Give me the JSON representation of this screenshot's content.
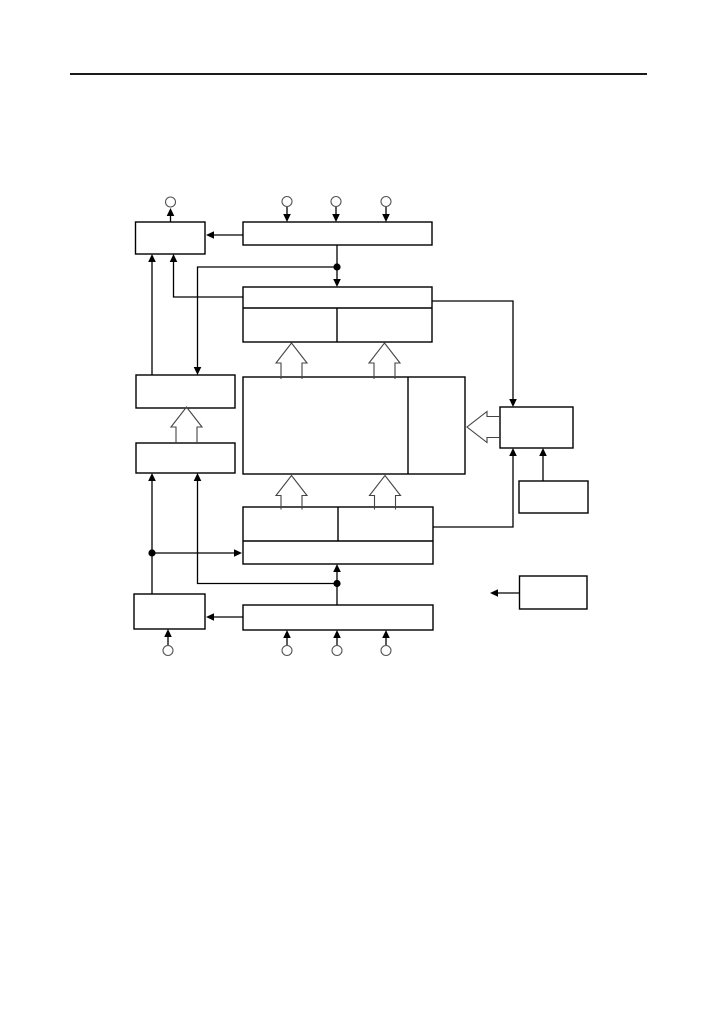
{
  "page": {
    "background": "#ffffff",
    "width": 717,
    "height": 1013
  },
  "diagram": {
    "line_color": "#000000",
    "box_fill": "#ffffff",
    "box_stroke": "#000000",
    "pin_stroke": "#555555",
    "hollow_arrow_stroke": "#444444",
    "rule_color": "#1a1a1a",
    "pin_radius": 5,
    "junction_radius": 3.6,
    "rules": [
      {
        "name": "header-rule",
        "x1": 70,
        "y1": 74,
        "x2": 647,
        "y2": 74,
        "w": 2
      }
    ],
    "boxes": [
      {
        "name": "top-left-box",
        "label": "",
        "x": 135.5,
        "y": 222,
        "w": 69.5,
        "h": 32
      },
      {
        "name": "top-wide-box",
        "label": "",
        "x": 243,
        "y": 222,
        "w": 189,
        "h": 23
      },
      {
        "name": "top-group-box",
        "label": "",
        "x": 243,
        "y": 287,
        "w": 189,
        "h": 55
      },
      {
        "name": "upper-left-box",
        "label": "",
        "x": 136,
        "y": 375,
        "w": 99,
        "h": 33
      },
      {
        "name": "lower-left-box",
        "label": "",
        "x": 136,
        "y": 443,
        "w": 99,
        "h": 30
      },
      {
        "name": "central-box",
        "label": "",
        "x": 243,
        "y": 377,
        "w": 222,
        "h": 97
      },
      {
        "name": "right-box",
        "label": "",
        "x": 500,
        "y": 407,
        "w": 73,
        "h": 41
      },
      {
        "name": "small-right-box",
        "label": "",
        "x": 519,
        "y": 481,
        "w": 69,
        "h": 32
      },
      {
        "name": "lower-group-box",
        "label": "",
        "x": 243,
        "y": 507,
        "w": 190,
        "h": 57
      },
      {
        "name": "bottom-wide-box",
        "label": "",
        "x": 243,
        "y": 605,
        "w": 190,
        "h": 25
      },
      {
        "name": "bottom-left-box",
        "label": "",
        "x": 134,
        "y": 594,
        "w": 71,
        "h": 35
      },
      {
        "name": "standalone-box",
        "label": "",
        "x": 519.5,
        "y": 576,
        "w": 67.5,
        "h": 33
      }
    ],
    "dividers": [
      {
        "name": "top-group-divider-h",
        "x1": 243,
        "y1": 308,
        "x2": 432,
        "y2": 308
      },
      {
        "name": "top-group-divider-v",
        "x1": 337,
        "y1": 308,
        "x2": 337,
        "y2": 342
      },
      {
        "name": "central-box-divider-v",
        "x1": 408,
        "y1": 377,
        "x2": 408,
        "y2": 474
      },
      {
        "name": "lower-group-divider-h",
        "x1": 243,
        "y1": 541,
        "x2": 433,
        "y2": 541
      },
      {
        "name": "lower-group-divider-v",
        "x1": 338,
        "y1": 507,
        "x2": 338,
        "y2": 541
      }
    ],
    "connectors": [
      {
        "name": "arrow-topleft-to-pin1",
        "points": [
          [
            170.5,
            222
          ],
          [
            170.5,
            208
          ]
        ]
      },
      {
        "name": "arrow-pin2-to-topwide",
        "points": [
          [
            287,
            207
          ],
          [
            287,
            222
          ]
        ]
      },
      {
        "name": "arrow-pin3-to-topwide",
        "points": [
          [
            336,
            207
          ],
          [
            336,
            222
          ]
        ]
      },
      {
        "name": "arrow-pin4-to-topwide",
        "points": [
          [
            386,
            207
          ],
          [
            386,
            222
          ]
        ]
      },
      {
        "name": "arrow-topwide-to-topleft",
        "points": [
          [
            243,
            235
          ],
          [
            206,
            235
          ]
        ]
      },
      {
        "name": "arrow-topwide-to-topgroup",
        "points": [
          [
            337,
            245
          ],
          [
            337,
            287
          ]
        ]
      },
      {
        "name": "arrow-junction-top-to-upperleft",
        "points": [
          [
            337,
            267
          ],
          [
            197.5,
            267
          ],
          [
            197.5,
            375
          ]
        ]
      },
      {
        "name": "arrow-upperleft-to-topleft",
        "points": [
          [
            152,
            375
          ],
          [
            152,
            254
          ]
        ]
      },
      {
        "name": "arrow-topgroup-to-topleft",
        "points": [
          [
            243,
            297
          ],
          [
            173.5,
            297
          ],
          [
            173.5,
            254
          ]
        ]
      },
      {
        "name": "arrow-topgroup-to-rightbox",
        "points": [
          [
            432,
            301
          ],
          [
            513,
            301
          ],
          [
            513,
            407
          ]
        ]
      },
      {
        "name": "arrow-lowergroup-to-rightbox",
        "points": [
          [
            433,
            527
          ],
          [
            513,
            527
          ],
          [
            513,
            448
          ]
        ]
      },
      {
        "name": "arrow-smallright-to-rightbox",
        "points": [
          [
            543,
            481
          ],
          [
            543,
            448
          ]
        ]
      },
      {
        "name": "arrow-bottomleft-to-lowerleft",
        "points": [
          [
            152,
            594
          ],
          [
            152,
            473
          ]
        ]
      },
      {
        "name": "arrow-junction-left-to-lowergroup",
        "points": [
          [
            152,
            553
          ],
          [
            242,
            553
          ]
        ]
      },
      {
        "name": "arrow-bottomwide-to-lowergroup",
        "points": [
          [
            337,
            605
          ],
          [
            337,
            564
          ]
        ]
      },
      {
        "name": "arrow-junction-bottom-to-lowerleft",
        "points": [
          [
            337,
            583.5
          ],
          [
            197.5,
            583.5
          ],
          [
            197.5,
            473
          ]
        ]
      },
      {
        "name": "arrow-bottomwide-to-bottomleft",
        "points": [
          [
            243,
            617
          ],
          [
            206,
            617
          ]
        ]
      },
      {
        "name": "arrow-pin5-to-bottomleft",
        "points": [
          [
            168,
            645
          ],
          [
            168,
            629
          ]
        ]
      },
      {
        "name": "arrow-pin6-to-bottomwide",
        "points": [
          [
            287,
            645
          ],
          [
            287,
            630
          ]
        ]
      },
      {
        "name": "arrow-pin7-to-bottomwide",
        "points": [
          [
            337,
            645
          ],
          [
            337,
            630
          ]
        ]
      },
      {
        "name": "arrow-pin8-to-bottomwide",
        "points": [
          [
            386,
            645
          ],
          [
            386,
            630
          ]
        ]
      },
      {
        "name": "arrow-standalone-out",
        "points": [
          [
            519,
            593
          ],
          [
            490,
            593
          ]
        ]
      }
    ],
    "pins": [
      {
        "name": "pin-top-1",
        "cx": 170.5,
        "cy": 202
      },
      {
        "name": "pin-top-2",
        "cx": 287,
        "cy": 201.5
      },
      {
        "name": "pin-top-3",
        "cx": 336,
        "cy": 201.5
      },
      {
        "name": "pin-top-4",
        "cx": 386,
        "cy": 201.5
      },
      {
        "name": "pin-bottom-1",
        "cx": 168,
        "cy": 650.5
      },
      {
        "name": "pin-bottom-2",
        "cx": 287,
        "cy": 650.5
      },
      {
        "name": "pin-bottom-3",
        "cx": 337,
        "cy": 650.5
      },
      {
        "name": "pin-bottom-4",
        "cx": 386,
        "cy": 650.5
      }
    ],
    "junctions": [
      {
        "name": "junction-top",
        "cx": 337,
        "cy": 267
      },
      {
        "name": "junction-left",
        "cx": 152,
        "cy": 553
      },
      {
        "name": "junction-bottom",
        "cx": 337,
        "cy": 583.5
      }
    ],
    "hollow_arrows": [
      {
        "name": "bus-arrow-topgroup-left",
        "dir": "up",
        "tip": [
          291.5,
          343
        ],
        "len": 36
      },
      {
        "name": "bus-arrow-topgroup-right",
        "dir": "up",
        "tip": [
          384.5,
          343
        ],
        "len": 36
      },
      {
        "name": "bus-arrow-left-stack",
        "dir": "up",
        "tip": [
          186.5,
          407
        ],
        "len": 37
      },
      {
        "name": "bus-arrow-central-left",
        "dir": "up",
        "tip": [
          291.5,
          475.5
        ],
        "len": 34
      },
      {
        "name": "bus-arrow-central-right",
        "dir": "up",
        "tip": [
          385,
          475.5
        ],
        "len": 34
      },
      {
        "name": "bus-arrow-right-to-central",
        "dir": "left",
        "tip": [
          467,
          427
        ],
        "len": 34
      }
    ]
  }
}
